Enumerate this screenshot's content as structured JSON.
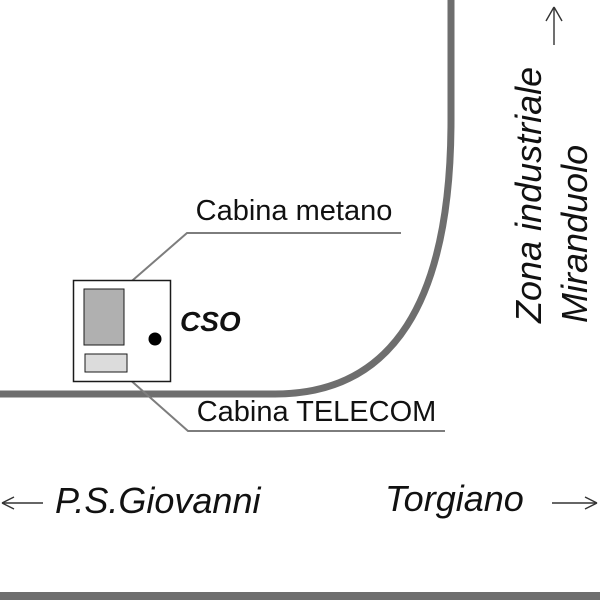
{
  "map": {
    "labels": {
      "cabina_metano": "Cabina metano",
      "cabina_telecom": "Cabina TELECOM",
      "site_marker": "CSO",
      "direction_up_line1": "Zona industriale",
      "direction_up_line2": "Miranduolo",
      "direction_left": "P.S.Giovanni",
      "direction_right": "Torgiano"
    },
    "icons": {
      "arrow_up": "arrow-up-icon",
      "arrow_left": "arrow-left-icon",
      "arrow_right": "arrow-right-icon"
    },
    "colors": {
      "background": "#ffffff",
      "road": "#6e6e6e",
      "leader": "#7d7d7d",
      "text": "#111111",
      "site_outline": "#1a1a1a",
      "site_fill": "#ffffff",
      "cabin_metano_fill": "#b0b0b0",
      "cabin_telecom_fill": "#dcdcdc",
      "marker_dot": "#000000",
      "arrow": "#333333"
    }
  }
}
